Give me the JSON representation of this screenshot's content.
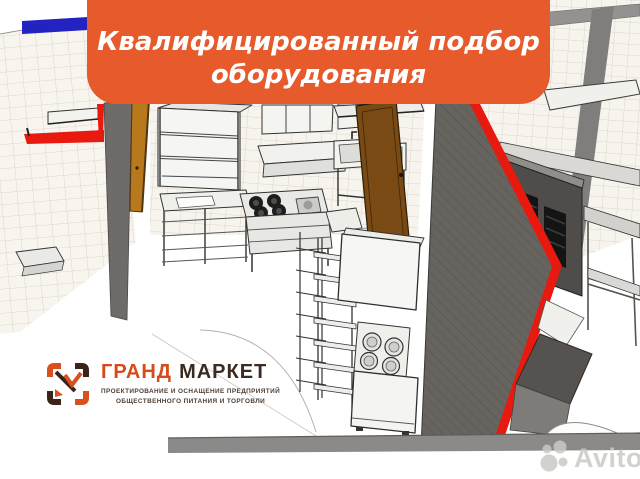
{
  "banner": {
    "line1": "Квалифицированный подбор",
    "line2": "оборудования",
    "bg_color": "#E65A2B",
    "text_color": "#FFFFFF"
  },
  "logo": {
    "word1": "ГРАНД",
    "word2": "МАРКЕТ",
    "word1_color": "#D84A1B",
    "word2_color": "#3B2B21",
    "tagline_line1": "ПРОЕКТИРОВАНИЕ И ОСНАЩЕНИЕ ПРЕДПРИЯТИЙ",
    "tagline_line2": "ОБЩЕСТВЕННОГО ПИТАНИЯ И ТОРГОВЛИ",
    "tagline_color": "#4E3D31",
    "icon": "bracketed-square-with-check-mark"
  },
  "watermark": {
    "text": "Avito",
    "icon": "avito-circles-logo"
  },
  "scene": {
    "description": "3D SketchUp-style rendering of a commercial kitchen project: tiled walls, gray partition walls with red top edges, wooden doors, stainless equipment (shelving racks, range with burners, hood shelf, sinks, work tables, kettle unit, refrigerated counter)",
    "colors": {
      "wall_red_edge": "#E8190E",
      "wall_gray": "#6E6B69",
      "right_wall_gray": "#67645F",
      "tile_bg": "#F8F5EF",
      "tile_line": "#DDD6CB",
      "blue_stripe": "#2323C2",
      "door_wood_light": "#B8791C",
      "door_wood_dark": "#7A4A14",
      "equipment_white": "#F5F5F3",
      "equipment_outline": "#333333",
      "dark_counter": "#4F4C4A",
      "floor_strip": "#8C8A88"
    }
  }
}
